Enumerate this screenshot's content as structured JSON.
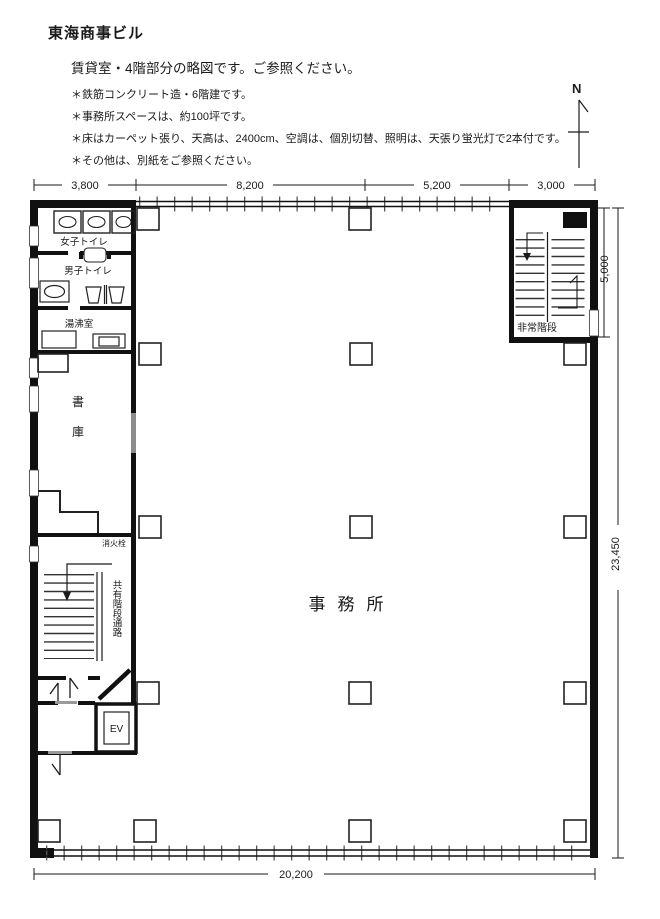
{
  "header": {
    "title": "東海商事ビル",
    "subtitle": "賃貸室・4階部分の略図です。ご参照ください。",
    "notes": [
      "＊鉄筋コンクリート造・6階建です。",
      "＊事務所スペースは、約100坪です。",
      "＊床はカーペット張り、天高は、2400cm、空調は、個別切替、照明は、天張り蛍光灯で2本付です。",
      "＊その他は、別紙をご参照ください。"
    ]
  },
  "compass": {
    "label": "N"
  },
  "plan": {
    "rooms": {
      "womens_toilet": "女子トイレ",
      "mens_toilet": "男子トイレ",
      "kitchenette": "湯沸室",
      "storage_line1": "書",
      "storage_line2": "庫",
      "fire_hydrant": "消火栓",
      "shared_stairs": "共有階段通路",
      "elevator": "EV",
      "emergency_stairs": "非常階段",
      "office": "事務所"
    },
    "dimensions": {
      "top": [
        "3,800",
        "8,200",
        "5,200",
        "3,000"
      ],
      "right_upper": "5,000",
      "right_total": "23,450",
      "bottom": "20,200"
    },
    "colors": {
      "wall": "#111111",
      "line": "#1a1a1a",
      "door_gray": "#8c8c8c"
    }
  }
}
